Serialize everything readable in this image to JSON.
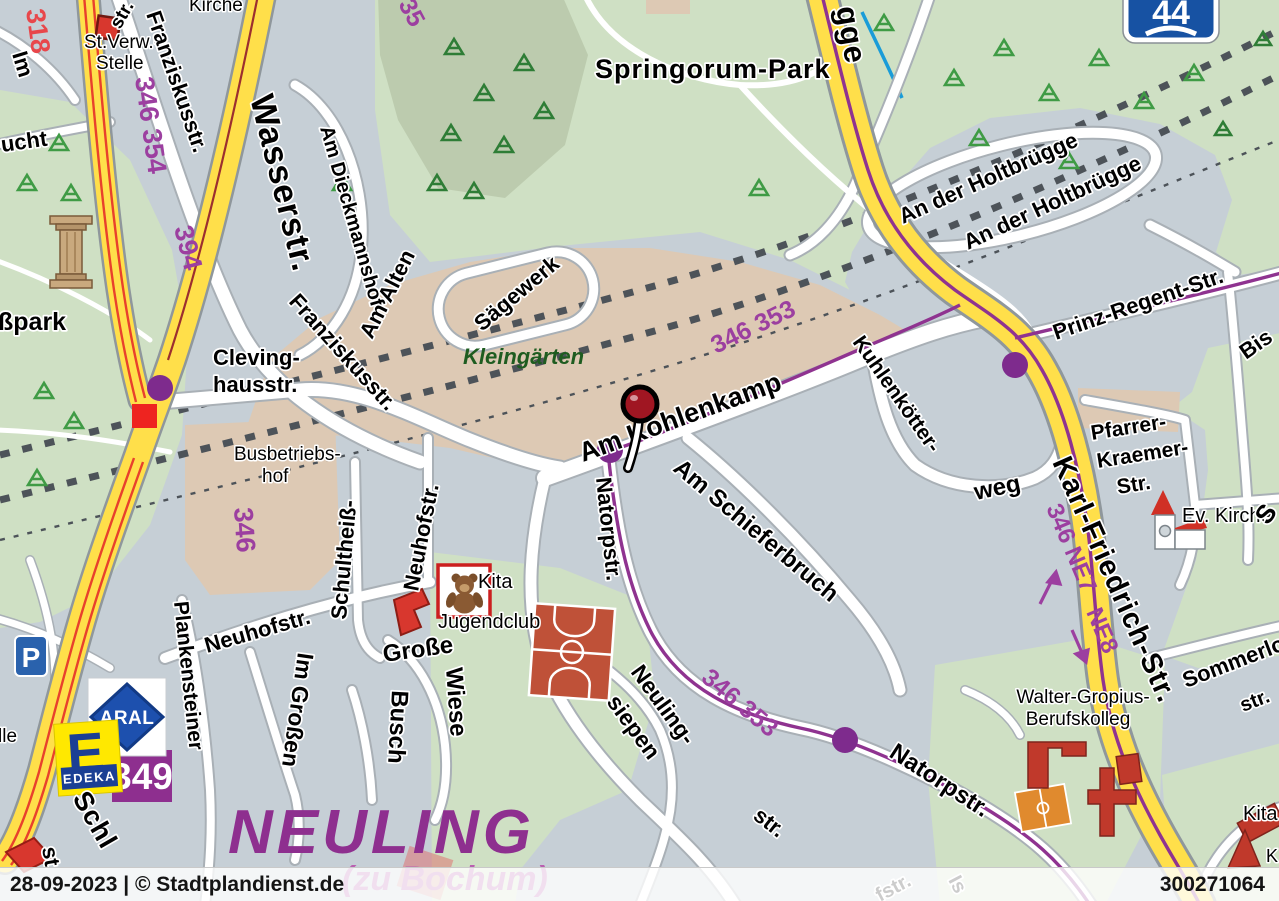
{
  "colors": {
    "base": "#c6cfd6",
    "park_green": "#cfe0c4",
    "forest_green": "#bccbae",
    "allotment_tan": "#ddc9b4",
    "road_yellow": "#ffdf4a",
    "transit_purple": "#8f3390",
    "transit_label_purple": "#9c3fa0",
    "district_purple": "#8e2f8f",
    "railway_gray": "#4d5359",
    "marker_red": "#a01622",
    "tram_red": "#e8412c",
    "stream_blue": "#1a9cd8"
  },
  "footer": {
    "left": "28-09-2023 | © Stadtplandienst.de",
    "right": "300271064"
  },
  "signs": {
    "a44": "44",
    "line_349": "349",
    "parking": "P",
    "aral": "ARAL",
    "edeka_e": "E",
    "edeka": "EDEKA"
  },
  "district": {
    "name": "NEULING",
    "suffix": "(zu Bochum)"
  },
  "areas": {
    "springorum": "Springorum-Park",
    "sspark": "ßpark",
    "kleingaerten": "Kleingärten",
    "busbetriebshof1": "Busbetriebs-",
    "busbetriebshof2": "hof"
  },
  "pois": {
    "st_verw1": "St.Verw.-",
    "st_verw2": "Stelle",
    "kirche": "Kirche",
    "jugendclub": "Jugendclub",
    "kita": "Kita",
    "ev_kirche": "Ev. Kirche",
    "wgk1": "Walter-Gropius-",
    "wgk2": "Berufskolleg"
  },
  "streets": {
    "wasserstr": "Wasserstr.",
    "franziskusstr": "Franziskusstr.",
    "am_dieckmannshof": "Am Dieckmannshof",
    "am_alten": "Am Alten",
    "saegewerk": "Sägewerk",
    "clevinghaus1": "Cleving-",
    "clevinghaus2": "hausstr.",
    "schultheiss": "Schultheiß-",
    "neuhofstr": "Neuhofstr.",
    "grosse": "Große",
    "wiese": "Wiese",
    "im_grossen": "Im Großen",
    "busch": "Busch",
    "plankensteiner": "Plankensteiner",
    "schl": "Schl",
    "st": "st",
    "lle": "lle",
    "ucht": "ucht",
    "im": "Im",
    "str": "str.",
    "am_kohlenkamp": "Am Kohlenkamp",
    "am_schieferbruch": "Am Schieferbruch",
    "natorpstr": "Natorpstr.",
    "neuling1": "Neuling-",
    "neuling2": "siepen",
    "kuhlenkoetter": "Kuhlenkötter-",
    "weg": "weg",
    "an_der_holtbruegge": "An der Holtbrügge",
    "prinz_regent": "Prinz-Regent-Str.",
    "pfarrer1": "Pfarrer-",
    "pfarrer2": "Kraemer-",
    "pfarrer3": "Str.",
    "karl_friedrich": "Karl-Friedrich-Str.",
    "sommerlo": "Sommerlo",
    "bis": "Bis",
    "s": "S",
    "gge": "gge",
    "k": "K",
    "fstr": "fstr.",
    "is": "Is"
  },
  "transit": {
    "b318": "318",
    "l346_354": "346 354",
    "l394": "394",
    "l346": "346",
    "l346_353": "346 353",
    "l346_ne7": "346 NE7",
    "ne8": "NE8",
    "l35": "35"
  }
}
